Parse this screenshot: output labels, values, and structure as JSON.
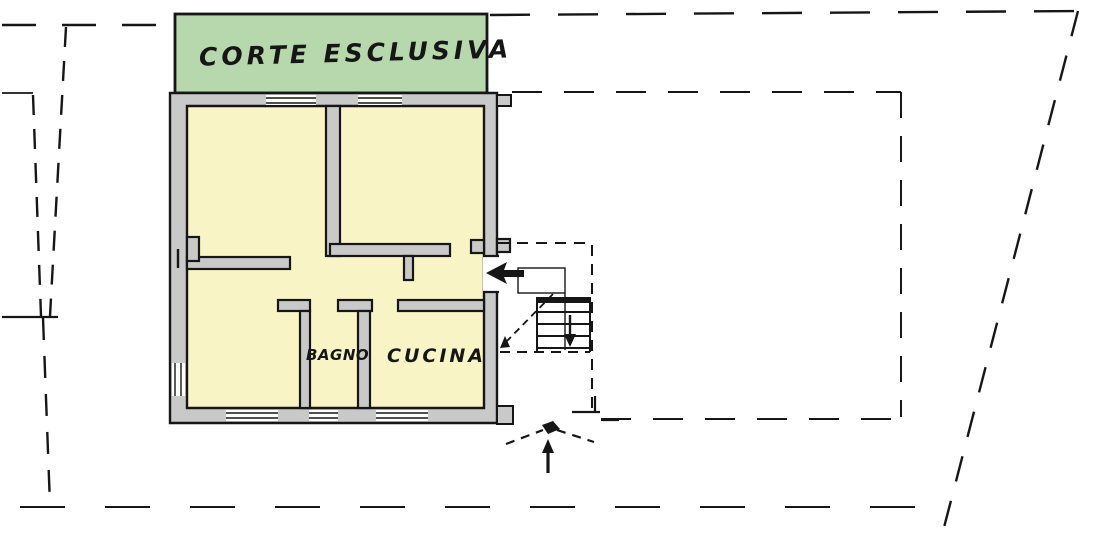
{
  "document": {
    "kind": "scanned cadastral floor plan",
    "language": "Italian"
  },
  "labels": {
    "courtyard": "CORTE ESCLUSIVA",
    "bathroom": "BAGNO",
    "kitchen": "CUCINA"
  },
  "colors": {
    "background": "#ffffff",
    "line": "#161616",
    "courtyard_fill": "#b7d8ad",
    "room_fill": "#f8f4c6",
    "wall_fill": "#c9c9c9",
    "window_fill": "#ffffff"
  },
  "icons": {
    "entry_arrow": "left-arrow into apartment door",
    "stairs_down_arrow": "down-arrow on staircase",
    "stair_walk_arrow": "diagonal dashed walk-line arrow",
    "entrance_arrow": "up-arrow at building entrance"
  }
}
